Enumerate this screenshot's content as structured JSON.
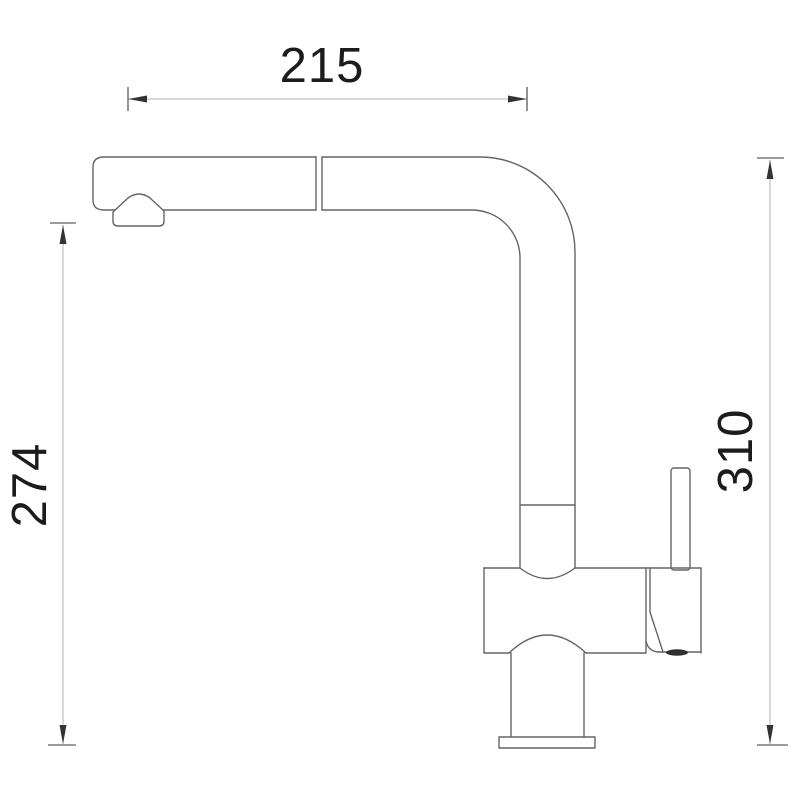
{
  "diagram": {
    "kind": "technical-dimension-drawing",
    "dimensions": {
      "top": {
        "label": "215",
        "orientation": "horizontal"
      },
      "left": {
        "label": "274",
        "orientation": "vertical"
      },
      "right": {
        "label": "310",
        "orientation": "vertical"
      }
    },
    "colors": {
      "background": "#ffffff",
      "outline": "#656565",
      "fill": "#ffffff",
      "dim_line": "#b2b2b2",
      "tick": "#7a7a7a",
      "arrow": "#333333",
      "dark_detail": "#2f2f2f",
      "text": "#1c1c1c"
    }
  }
}
